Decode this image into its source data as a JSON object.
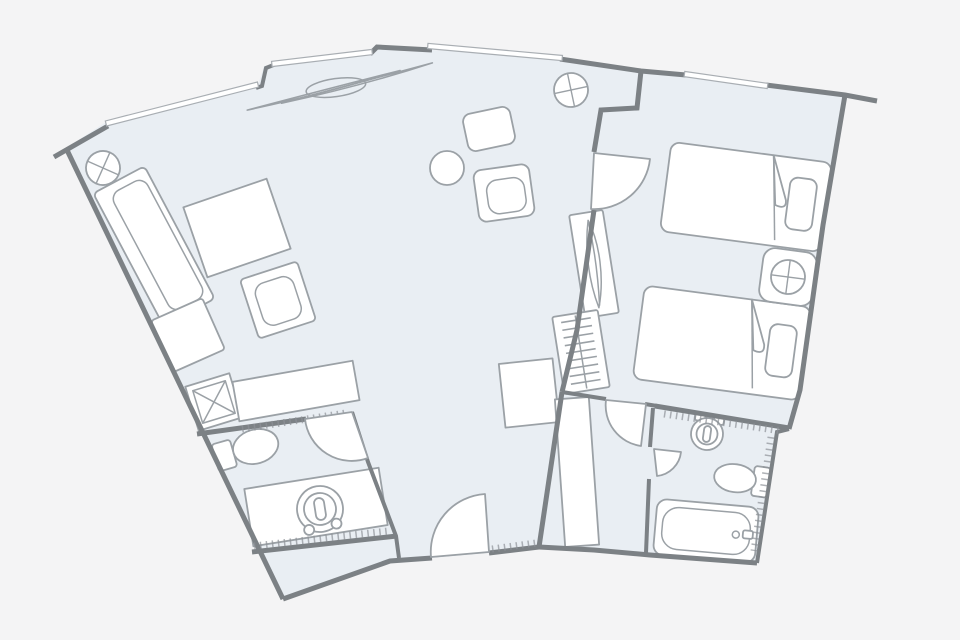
{
  "meta": {
    "title": "Hotel suite floor plan",
    "canvas": {
      "width": 960,
      "height": 640
    }
  },
  "colors": {
    "background": "#f4f4f5",
    "room_fill": "#e9eef3",
    "wall": "#7c8185",
    "furniture_stroke": "#9ba1a6",
    "furniture_fill": "#ffffff",
    "thin_line": "#a9aeb3",
    "hatch": "#8d9297"
  },
  "plan": {
    "layout": "fan-shaped suite, two units joined by a connecting door, curved corridor at bottom",
    "window_count": 4,
    "units": [
      {
        "name": "living-room-unit",
        "rooms": [
          "living-room",
          "bathroom",
          "entry-vestibule"
        ],
        "fixtures": [
          "sofa",
          "side-table",
          "armchair",
          "ottoman",
          "round-coffee-table",
          "lounge-chair-1",
          "lounge-chair-2",
          "console-table",
          "storage-box",
          "cabinet",
          "curtain",
          "column-1",
          "column-2",
          "toilet",
          "vanity-with-sink",
          "entry-door",
          "bathroom-door"
        ]
      },
      {
        "name": "bedroom-unit",
        "rooms": [
          "bedroom",
          "vestibule",
          "bathroom"
        ],
        "fixtures": [
          "bed-1",
          "bed-2",
          "nightstand",
          "table-lamp",
          "plant-console",
          "hanger-closet",
          "wardrobe",
          "sink",
          "toilet",
          "bathtub",
          "connecting-door",
          "vestibule-door",
          "bathroom-door"
        ]
      }
    ]
  }
}
